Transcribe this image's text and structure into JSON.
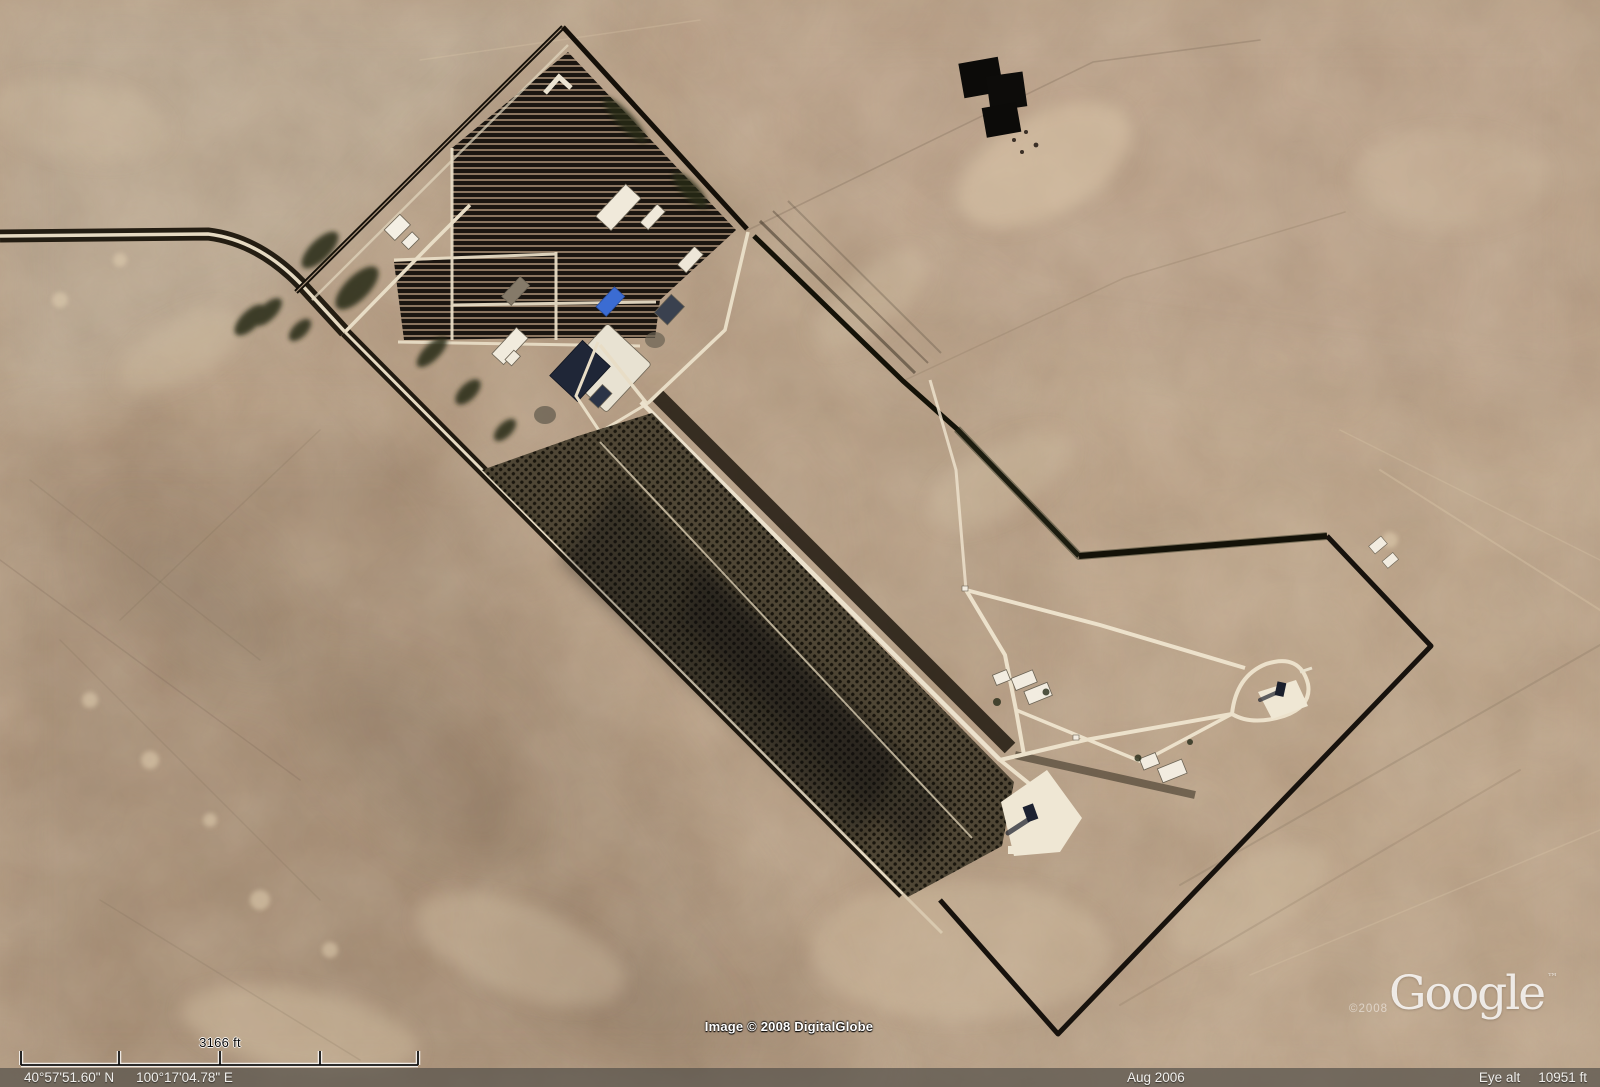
{
  "overlay": {
    "scale_bar": {
      "label": "3166 ft",
      "ticks": 5
    },
    "status_bar": {
      "latitude": "40°57'51.60\" N",
      "longitude": "100°17'04.78\" E",
      "imagery_date": "Aug 2006",
      "eye_alt_label": "Eye alt",
      "eye_alt_value": "10951 ft"
    },
    "credits": {
      "imagery": "Image © 2008 DigitalGlobe"
    },
    "logo": {
      "copyright": "©2008",
      "text": "Google",
      "tm": "™"
    }
  },
  "colors": {
    "desert_base": "#b2987e",
    "desert_dark": "#8d7560",
    "desert_light": "#dcc9ab",
    "road_light": "#e9ddc5",
    "wall_dark": "#17120d",
    "vegetation_dark": "#272c19",
    "building_white": "#f2ece0",
    "assembly_building_navy": "#1f2637",
    "blue_roof": "#3b6cd3",
    "status_bar_text": "#f0efec"
  }
}
